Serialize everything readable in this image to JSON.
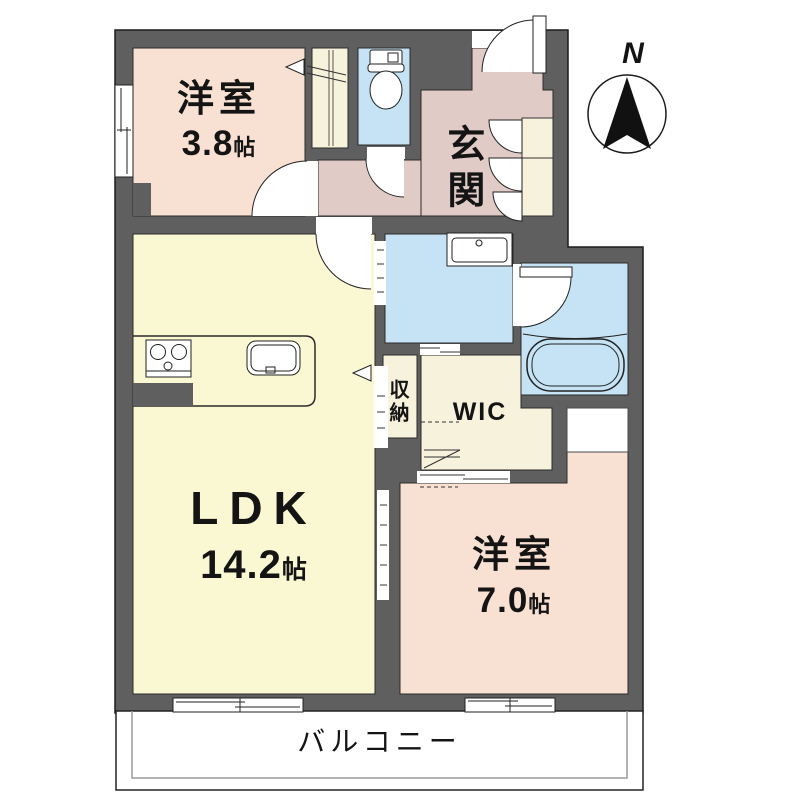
{
  "compass": {
    "label": "N"
  },
  "rooms": {
    "west_room_small": {
      "label": "洋室",
      "area": "3.8",
      "unit": "帖"
    },
    "entrance": {
      "label": "玄関"
    },
    "ldk": {
      "label": "LDK",
      "area": "14.2",
      "unit": "帖"
    },
    "storage": {
      "label": "収納"
    },
    "wic": {
      "label": "WIC"
    },
    "west_room_large": {
      "label": "洋室",
      "area": "7.0",
      "unit": "帖"
    },
    "balcony": {
      "label": "バルコニー"
    }
  },
  "colors": {
    "wall": "#5F5F5F",
    "room-pink": "#F8E1D3",
    "room-yellow": "#FAF8D2",
    "room-mauve": "#E0CBC7",
    "room-blue": "#C5E3F4",
    "room-cream": "#F7F2DC",
    "outline": "#222222"
  }
}
